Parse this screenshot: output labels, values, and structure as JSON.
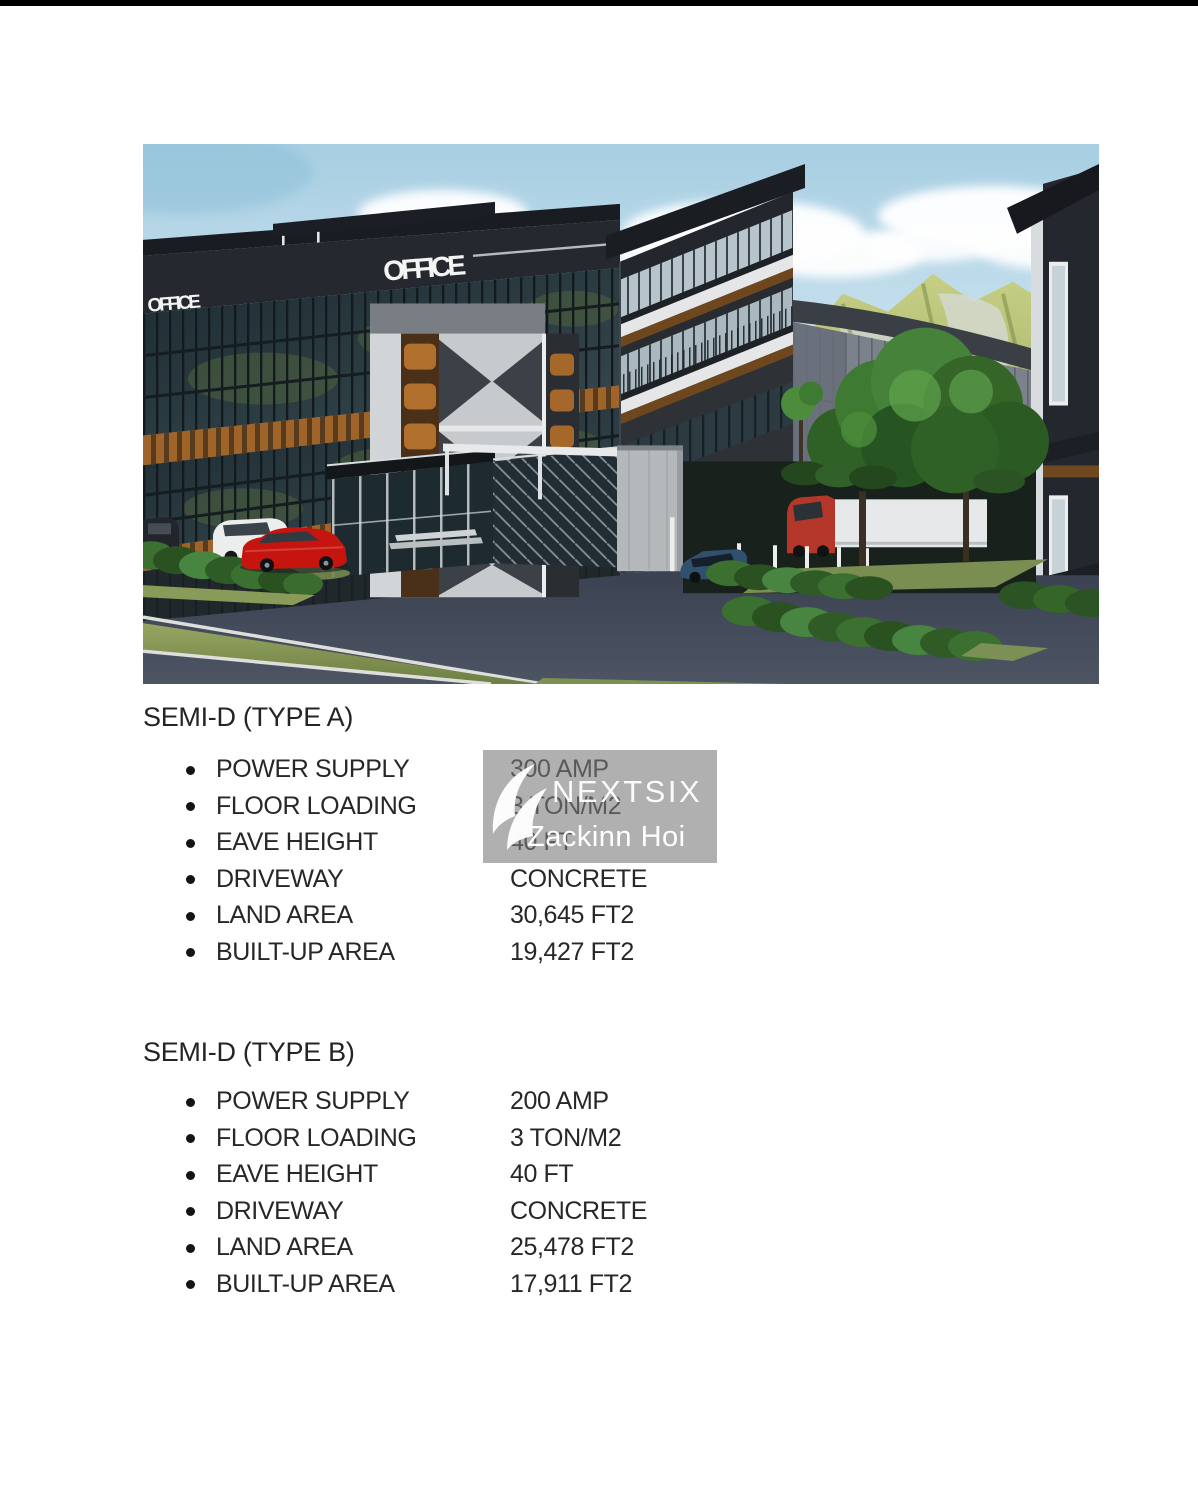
{
  "page": {
    "background": "#ffffff",
    "top_bar_color": "#000000",
    "text_color": "#262626"
  },
  "photo": {
    "scene": "3d-rendering-semi-detached-factory-office",
    "signs": {
      "left": "OFFICE",
      "right": "OFFICE"
    }
  },
  "watermark": {
    "brand": "NEXTSIX",
    "user": "Zackinn Hoi",
    "overlay_color": "#7c7c7c",
    "text_color": "#ffffff"
  },
  "sections": [
    {
      "heading": "SEMI-D (TYPE A)",
      "rows": [
        {
          "label": "POWER SUPPLY",
          "value": "300 AMP"
        },
        {
          "label": "FLOOR LOADING",
          "value": "3 TON/M2"
        },
        {
          "label": "EAVE HEIGHT",
          "value": "40 FT"
        },
        {
          "label": "DRIVEWAY",
          "value": "CONCRETE"
        },
        {
          "label": "LAND AREA",
          "value": "30,645 FT2"
        },
        {
          "label": "BUILT-UP AREA",
          "value": "19,427 FT2"
        }
      ]
    },
    {
      "heading": "SEMI-D (TYPE B)",
      "rows": [
        {
          "label": "POWER SUPPLY",
          "value": "200 AMP"
        },
        {
          "label": "FLOOR LOADING",
          "value": "3 TON/M2"
        },
        {
          "label": "EAVE HEIGHT",
          "value": "40 FT"
        },
        {
          "label": "DRIVEWAY",
          "value": "CONCRETE"
        },
        {
          "label": "LAND AREA",
          "value": "25,478 FT2"
        },
        {
          "label": "BUILT-UP AREA",
          "value": "17,911 FT2"
        }
      ]
    }
  ]
}
